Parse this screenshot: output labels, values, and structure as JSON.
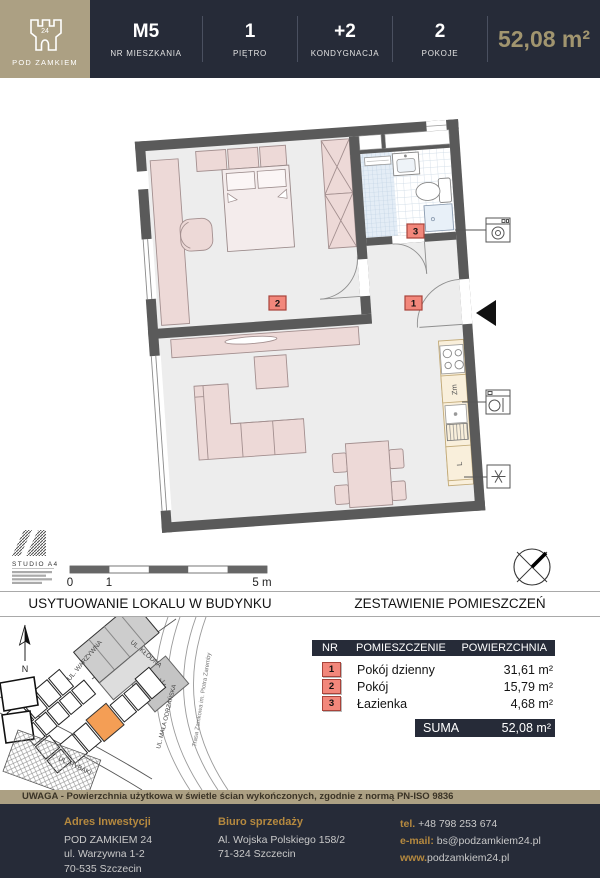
{
  "header": {
    "logo": {
      "number": "24",
      "name": "POD ZAMKIEM"
    },
    "stats": [
      {
        "value": "M5",
        "label": "NR MIESZKANIA"
      },
      {
        "value": "1",
        "label": "PIĘTRO"
      },
      {
        "value": "+2",
        "label": "KONDYGNACJA"
      },
      {
        "value": "2",
        "label": "POKOJE"
      }
    ],
    "area": "52,08 m²"
  },
  "plan": {
    "badges": [
      "1",
      "2",
      "3"
    ],
    "kitchen": {
      "dishwasher": "Zm",
      "fridge": "L"
    },
    "scale": {
      "labels": [
        "0",
        "1",
        "5 m"
      ]
    },
    "studio_name": "STUDIO A4"
  },
  "sections": {
    "left_title": "USYTUOWANIE LOKALU W BUDYNKU",
    "right_title": "ZESTAWIENIE POMIESZCZEŃ"
  },
  "map": {
    "north": "N",
    "streets": [
      "UL. KŁODNA",
      "UL. WARZYWNA",
      "UL. RYBAKI",
      "UL. MAŁA ODRZAŃSKA",
      "Trasa Zamkowa im. Piotra Zaremby"
    ]
  },
  "table": {
    "headers": {
      "nr": "NR",
      "room": "POMIESZCZENIE",
      "area": "POWIERZCHNIA"
    },
    "rows": [
      {
        "nr": "1",
        "room": "Pokój dzienny",
        "area": "31,61 m²"
      },
      {
        "nr": "2",
        "room": "Pokój",
        "area": "15,79 m²"
      },
      {
        "nr": "3",
        "room": "Łazienka",
        "area": "4,68 m²"
      }
    ],
    "sum_label": "SUMA",
    "sum_area": "52,08 m²"
  },
  "notice": "UWAGA - Powierzchnia użytkowa w świetle ścian wykończonych, zgodnie z normą PN-ISO 9836",
  "footer": {
    "col1": {
      "title": "Adres Inwestycji",
      "lines": [
        "POD ZAMKIEM 24",
        "ul. Warzywna 1-2",
        "70-535 Szczecin"
      ]
    },
    "col2": {
      "title": "Biuro sprzedaży",
      "lines": [
        "Al. Wojska Polskiego 158/2",
        "71-324 Szczecin"
      ]
    },
    "contact": {
      "tel_label": "tel.",
      "tel": "+48 798 253 674",
      "email_label": "e-mail:",
      "email": "bs@podzamkiem24.pl",
      "www_label": "www.",
      "www": "podzamkiem24.pl"
    }
  },
  "colors": {
    "navy": "#262b38",
    "tan": "#aca083",
    "tan_text": "#a1956f",
    "wall": "#5a5a5a",
    "furniture_pink": "#edd9d7",
    "kitchen_cream": "#f9efdb",
    "badge": "#f2877b",
    "map_highlight": "#f49e55",
    "footer_label": "#b5893f"
  }
}
